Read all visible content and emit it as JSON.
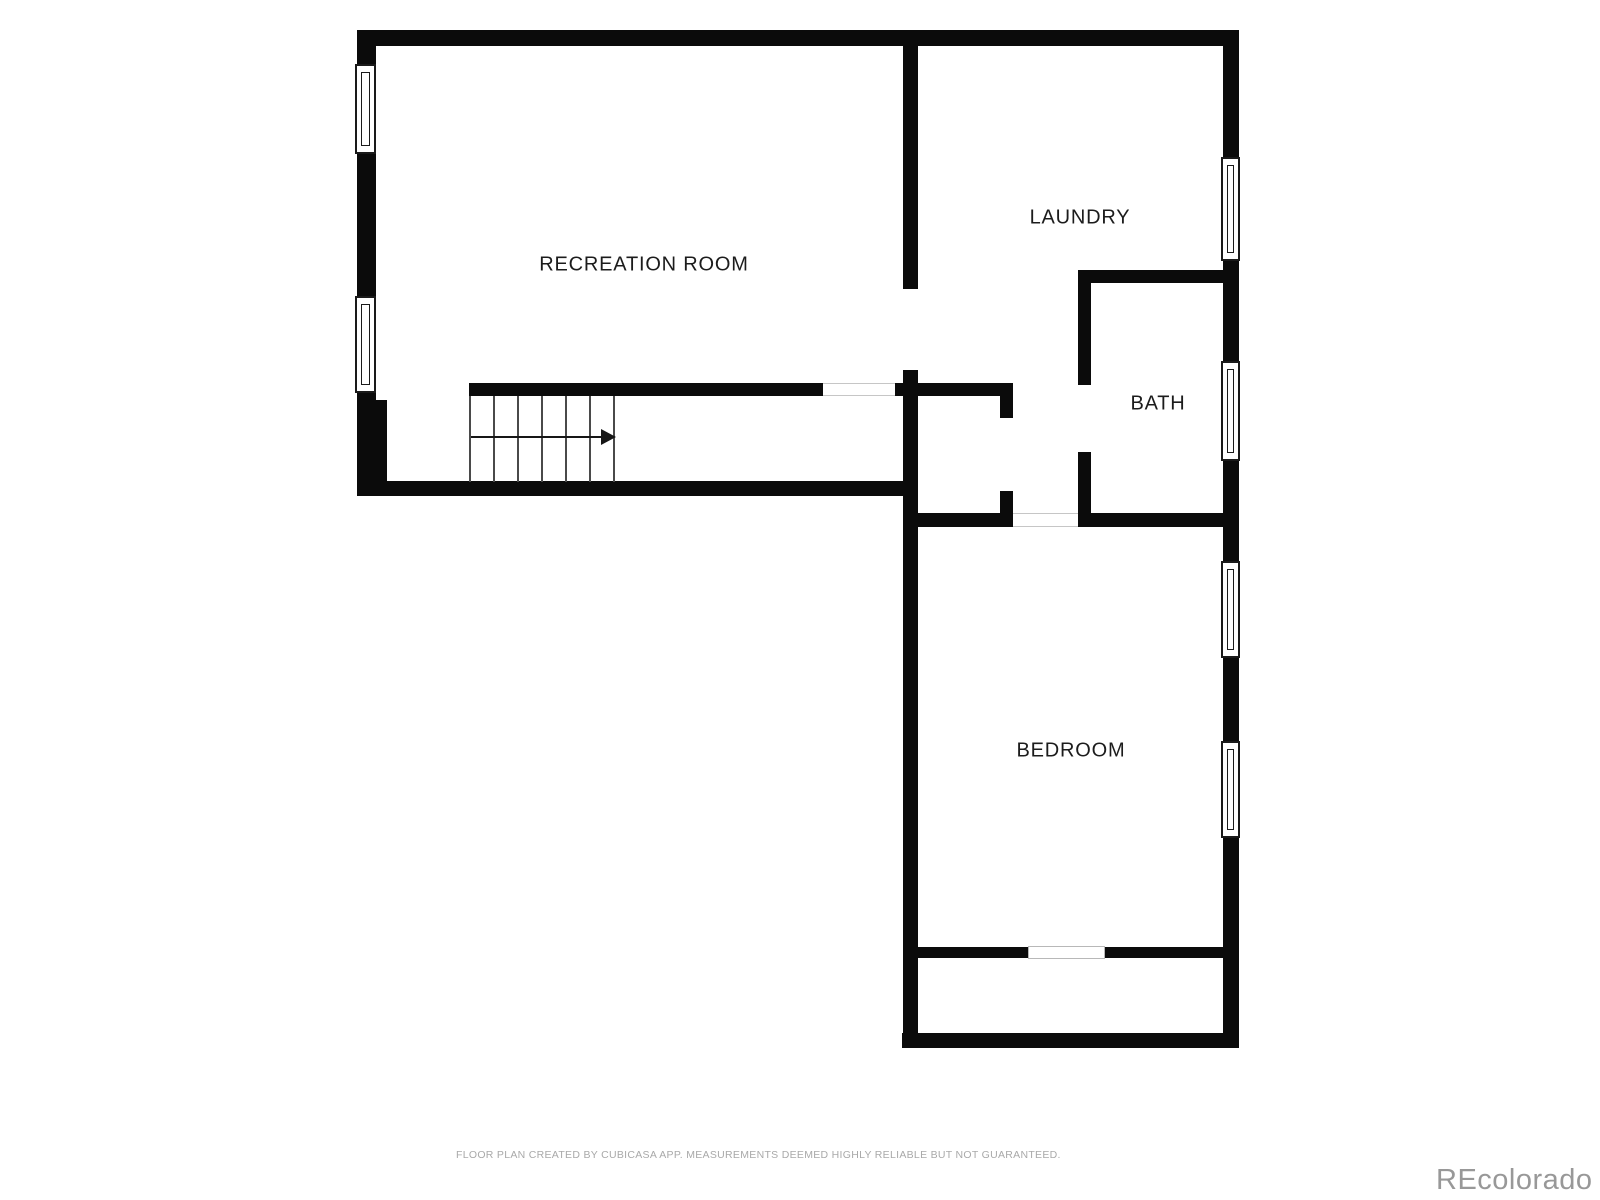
{
  "page": {
    "footer": "FLOOR PLAN CREATED BY CUBICASA APP. MEASUREMENTS DEEMED HIGHLY RELIABLE BUT NOT GUARANTEED.",
    "watermark": "REcolorado"
  },
  "colors": {
    "wall": "#0b0b0b",
    "window_frame": "#1a1a1a",
    "label": "#1c1c1c",
    "stair_tread": "#4a4a4a",
    "threshold": "#c6c6c6",
    "footer_text": "#a9a9a9",
    "watermark_text": "#989898",
    "background": "#ffffff"
  },
  "rooms": [
    {
      "name": "RECREATION ROOM",
      "cx": 644,
      "cy": 265
    },
    {
      "name": "LAUNDRY",
      "cx": 1080,
      "cy": 218
    },
    {
      "name": "BATH",
      "cx": 1158,
      "cy": 404
    },
    {
      "name": "BEDROOM",
      "cx": 1071,
      "cy": 751
    }
  ],
  "walls": [
    {
      "x": 357,
      "y": 30,
      "w": 882,
      "h": 16
    },
    {
      "x": 357,
      "y": 30,
      "w": 19,
      "h": 466
    },
    {
      "x": 375,
      "y": 400,
      "w": 12,
      "h": 96
    },
    {
      "x": 357,
      "y": 481,
      "w": 561,
      "h": 15
    },
    {
      "x": 903,
      "y": 30,
      "w": 15,
      "h": 259
    },
    {
      "x": 903,
      "y": 370,
      "w": 15,
      "h": 678
    },
    {
      "x": 1223,
      "y": 30,
      "w": 16,
      "h": 1018
    },
    {
      "x": 469,
      "y": 383,
      "w": 354,
      "h": 13
    },
    {
      "x": 895,
      "y": 383,
      "w": 118,
      "h": 13
    },
    {
      "x": 1000,
      "y": 383,
      "w": 13,
      "h": 35
    },
    {
      "x": 1000,
      "y": 491,
      "w": 13,
      "h": 36
    },
    {
      "x": 903,
      "y": 513,
      "w": 110,
      "h": 14
    },
    {
      "x": 1078,
      "y": 513,
      "w": 147,
      "h": 14
    },
    {
      "x": 1078,
      "y": 270,
      "w": 13,
      "h": 115
    },
    {
      "x": 1078,
      "y": 452,
      "w": 13,
      "h": 66
    },
    {
      "x": 1078,
      "y": 270,
      "w": 145,
      "h": 13
    },
    {
      "x": 902,
      "y": 1033,
      "w": 337,
      "h": 15
    },
    {
      "x": 917,
      "y": 947,
      "w": 111,
      "h": 11
    },
    {
      "x": 1105,
      "y": 947,
      "w": 120,
      "h": 11
    }
  ],
  "windows": [
    {
      "x": 355,
      "y": 64,
      "w": 21,
      "h": 90
    },
    {
      "x": 355,
      "y": 296,
      "w": 21,
      "h": 97
    },
    {
      "x": 1221,
      "y": 157,
      "w": 19,
      "h": 104
    },
    {
      "x": 1221,
      "y": 361,
      "w": 19,
      "h": 100
    },
    {
      "x": 1221,
      "y": 561,
      "w": 19,
      "h": 97
    },
    {
      "x": 1221,
      "y": 741,
      "w": 19,
      "h": 97
    }
  ],
  "openings": [
    {
      "type": "threshold",
      "x": 823,
      "y": 383,
      "w": 72,
      "h": 13
    },
    {
      "type": "threshold",
      "x": 1013,
      "y": 513,
      "w": 65,
      "h": 14
    },
    {
      "type": "closet-door",
      "x": 1028,
      "y": 946,
      "w": 77,
      "h": 13
    }
  ],
  "stairs": {
    "x": 469,
    "y": 396,
    "w": 146,
    "h": 86,
    "tread_lines": 7,
    "tread_spacing": 24,
    "arrow": {
      "y": 437,
      "x_start": 471,
      "x_end": 601,
      "tip_len": 15
    }
  }
}
